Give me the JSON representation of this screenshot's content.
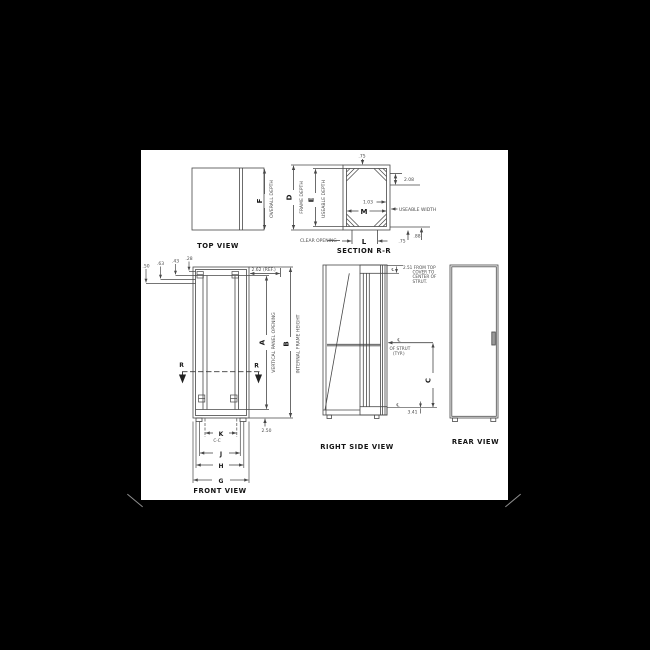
{
  "palette": {
    "background": "#000000",
    "paper": "#ffffff",
    "line_ink": "#474747",
    "label_ink": "#1a1a1a"
  },
  "views": {
    "top": {
      "title": "TOP VIEW",
      "dim_letter": "F",
      "dim_label": "OVERALL DEPTH"
    },
    "section": {
      "title": "SECTION R-R",
      "depth_letter": "D",
      "depth_label": "FRAME DEPTH",
      "useable_depth_letter": "E",
      "useable_depth_label": "USEABLE DEPTH",
      "useable_width_letter": "M",
      "useable_width_label": "USEABLE WIDTH",
      "clear_opening_letter": "L",
      "clear_opening_label": "CLEAR OPENING",
      "top_wall": ".75",
      "side_offset": "2.08",
      "inner_offset": "1.03",
      "bottom_wall": ".75",
      "bottom_flange": ".88"
    },
    "front": {
      "title": "FRONT VIEW",
      "panel_opening_letter": "A",
      "panel_opening_label": "VERTICAL PANEL OPENING",
      "frame_height_letter": "B",
      "frame_height_label": "INTERNAL FRAME HEIGHT",
      "rail_cc_letter": "K",
      "rail_cc_sub": "C-C",
      "dim_j": "J",
      "dim_h": "H",
      "dim_g": "G",
      "section_mark": "R",
      "offsets": [
        ".50",
        ".63",
        ".43",
        ".28"
      ],
      "top_ref": "2.62 (REF.)",
      "base_height": "2.50"
    },
    "side": {
      "title": "RIGHT SIDE VIEW",
      "top_note": [
        "2.51 FROM TOP",
        "COVER TO",
        "CENTER OF",
        "STRUT."
      ],
      "centerline": "℄",
      "strut_note_1": "OF STRUT",
      "strut_note_2": "(TYP.)",
      "height_letter": "C",
      "strut_to_base": "3.41"
    },
    "rear": {
      "title": "REAR VIEW"
    }
  }
}
